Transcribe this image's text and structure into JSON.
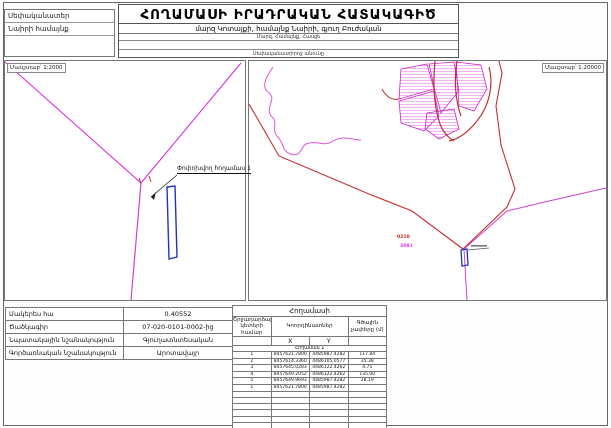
{
  "header": {
    "title": "ՀՈՂԱՄԱՍԻ ԻՐԱԴՐԱԿԱՆ ՀԱՏԱԿԱԳԻԾ",
    "owner_label": "Սեփականատեր",
    "owner_value": "Նաիրի համայնք",
    "address": "մարզ Կոտայքի, համայնք Նաիրի, գյուղ Բուժական",
    "address_caption": "Մարզ, Համայնք, Հասցե",
    "owner_caption": "Սեփականատիրոջ անունը"
  },
  "maps": {
    "left": {
      "scale_label": "Մասշտաբ՝ 1:2000",
      "plot_label": "Փոփոխվող հողամաս 1"
    },
    "right": {
      "scale_label": "Մասշտաբ՝ 1:20000",
      "red_parcel_label": "0210",
      "magenta_parcel_label": "3081"
    }
  },
  "info_table": {
    "rows": [
      {
        "label": "Մակերես հա",
        "value": "0.40552"
      },
      {
        "label": "Ծածկագիր",
        "value": "07-020-0101-0002-ից"
      },
      {
        "label": "Նպատակային նշանակություն",
        "value": "Գյուղատնտեսական"
      },
      {
        "label": "Գործառնական նշանակություն",
        "value": "Արոտավայր"
      }
    ]
  },
  "coords_table": {
    "title": "Հողամասի",
    "col_point_no": "Շրջադարձային կետերի համար",
    "col_coordinates": "Կոորդինատներ",
    "col_lengths": "Գծային չափերը (մ)",
    "x_label": "X",
    "y_label": "Y",
    "group_label": "Հողամաս 1",
    "rows": [
      {
        "n": "1",
        "x": "8457621.7800",
        "y": "4485987.4282",
        "len": "117.84"
      },
      {
        "n": "2",
        "x": "8457614.3360",
        "y": "4486105.0577",
        "len": "35.38"
      },
      {
        "n": "3",
        "x": "8457645.0283",
        "y": "4486122.4262",
        "len": "4.75"
      },
      {
        "n": "4",
        "x": "8457649.2052",
        "y": "4486122.4262",
        "len": "135.00"
      },
      {
        "n": "5",
        "x": "8457649.9693",
        "y": "4485987.4282",
        "len": "28.19"
      },
      {
        "n": "1",
        "x": "8457621.7800",
        "y": "4485987.4282",
        "len": ""
      }
    ],
    "empty_rows": 7
  },
  "colors": {
    "magenta": "#dd22dd",
    "red": "#c03030",
    "blue": "#2233bb"
  }
}
